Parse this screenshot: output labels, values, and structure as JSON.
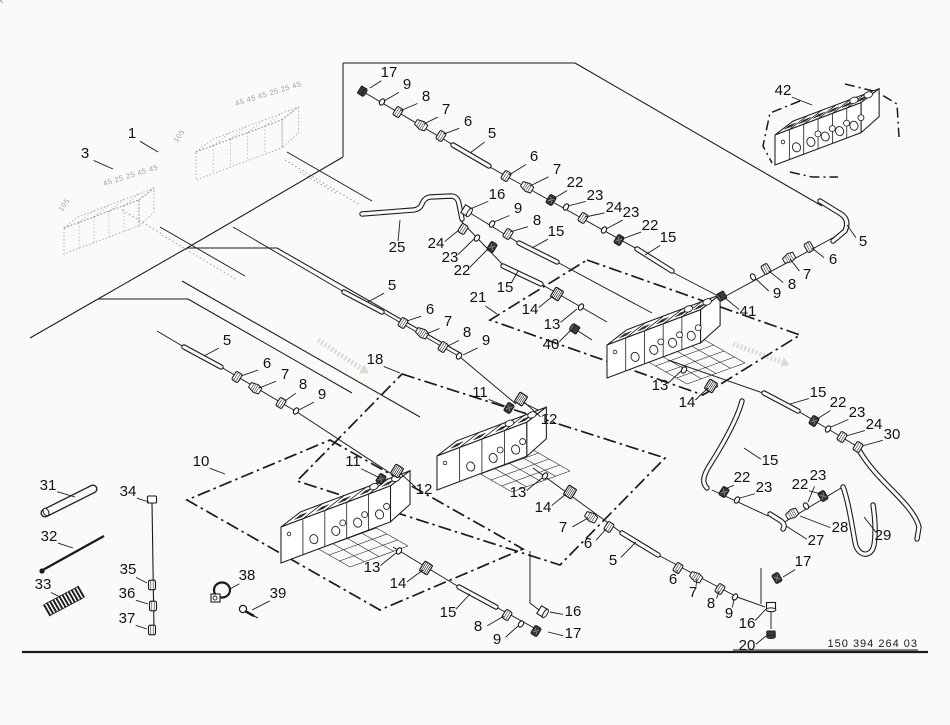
{
  "canvas": {
    "w": 950,
    "h": 725,
    "bg": "#fafaf8",
    "ink": "#1b1b1b"
  },
  "part_number": {
    "text": "150 394 264 03"
  },
  "border": {
    "x1": 22,
    "y1": 652,
    "x2": 928,
    "y2": 652
  },
  "pn_underline": {
    "x1": 733,
    "y1": 650,
    "x2": 918,
    "y2": 650
  },
  "frame_lines": [
    [
      343,
      63,
      343,
      157
    ],
    [
      343,
      63,
      575,
      63
    ],
    [
      575,
      63,
      822,
      206
    ],
    [
      343,
      157,
      187,
      248
    ],
    [
      187,
      248,
      277,
      248
    ],
    [
      277,
      248,
      462,
      354
    ],
    [
      187,
      248,
      98,
      299
    ],
    [
      98,
      299,
      188,
      299
    ],
    [
      188,
      299,
      352,
      393
    ],
    [
      182,
      281,
      420,
      417
    ],
    [
      98,
      299,
      30,
      338
    ]
  ],
  "areas": [
    {
      "pts": [
        [
          330,
          440
        ],
        [
          523,
          549
        ],
        [
          380,
          610
        ],
        [
          187,
          500
        ]
      ]
    },
    {
      "pts": [
        [
          402,
          374
        ],
        [
          665,
          458
        ],
        [
          560,
          565
        ],
        [
          297,
          481
        ]
      ]
    },
    {
      "pts": [
        [
          587,
          260
        ],
        [
          800,
          335
        ],
        [
          703,
          395
        ],
        [
          490,
          320
        ]
      ]
    }
  ],
  "brackets": [
    [
      [
        800,
        101
      ],
      [
        770,
        113
      ],
      [
        763,
        146
      ],
      [
        772,
        163
      ]
    ],
    [
      [
        845,
        84
      ],
      [
        877,
        92
      ],
      [
        897,
        104
      ],
      [
        899,
        137
      ]
    ],
    [
      [
        790,
        172
      ],
      [
        812,
        177
      ],
      [
        838,
        177
      ]
    ]
  ],
  "end_brackets": [
    [
      [
        530,
        551
      ],
      [
        530,
        603
      ],
      [
        539,
        610
      ]
    ],
    [
      [
        761,
        568
      ],
      [
        761,
        604
      ]
    ],
    [
      [
        771,
        612
      ],
      [
        771,
        629
      ]
    ]
  ],
  "hose_lines": [
    [
      362,
      91,
      455,
      146
    ],
    [
      488,
      166,
      637,
      249
    ],
    [
      672,
      272,
      722,
      298
    ],
    [
      470,
      213,
      519,
      243
    ],
    [
      557,
      262,
      652,
      313
    ],
    [
      460,
      220,
      505,
      267
    ],
    [
      541,
      284,
      607,
      322
    ],
    [
      578,
      331,
      592,
      340
    ],
    [
      233,
      227,
      344,
      292
    ],
    [
      382,
      312,
      460,
      357
    ],
    [
      460,
      357,
      516,
      404
    ],
    [
      522,
      402,
      548,
      415
    ],
    [
      157,
      331,
      184,
      347
    ],
    [
      221,
      367,
      297,
      412
    ],
    [
      297,
      412,
      390,
      473
    ],
    [
      393,
      547,
      459,
      587
    ],
    [
      496,
      607,
      538,
      630
    ],
    [
      533,
      468,
      622,
      533
    ],
    [
      658,
      555,
      737,
      597
    ],
    [
      737,
      597,
      765,
      607
    ],
    [
      840,
      234,
      700,
      310
    ],
    [
      668,
      360,
      763,
      393
    ],
    [
      798,
      411,
      858,
      447
    ],
    [
      712,
      490,
      768,
      516
    ],
    [
      783,
      523,
      841,
      488
    ],
    [
      287,
      152,
      372,
      201
    ],
    [
      160,
      227,
      245,
      276
    ]
  ],
  "pipes": [
    {
      "d": "M453,145 L489,166"
    },
    {
      "d": "M637,249 L672,271"
    },
    {
      "d": "M519,243 L557,262"
    },
    {
      "d": "M503,266 L541,284"
    },
    {
      "d": "M344,292 L382,312"
    },
    {
      "d": "M184,347 L221,367"
    },
    {
      "d": "M459,587 L496,607"
    },
    {
      "d": "M622,533 L658,555"
    },
    {
      "d": "M764,393 L798,411"
    },
    {
      "d": "M362,214 L414,210 Q420,209 422,204 Q424,198 430,197 L452,196 Q458,197 459,204 L462,219"
    },
    {
      "d": "M820,201 L841,214 Q850,220 845,231 L833,241"
    },
    {
      "d": "M843,487 C848,500 851,520 855,542 C857,556 871,559 874,545 C876,533 875,517 873,505"
    },
    {
      "d": "M858,448 C864,460 875,473 890,488 C905,503 916,515 919,527 L917,539"
    },
    {
      "d": "M742,401 C737,420 722,446 708,468 C703,477 702,483 707,488"
    },
    {
      "d": "M770,514 L781,521 Q786,525 783,529"
    }
  ],
  "fittings": [
    [
      "cap",
      362,
      91,
      32,
      1
    ],
    [
      "washer",
      382,
      102,
      32,
      0
    ],
    [
      "nut",
      398,
      112,
      32,
      0
    ],
    [
      "cone",
      421,
      125,
      32,
      0
    ],
    [
      "nut",
      441,
      136,
      32,
      0
    ],
    [
      "nut",
      506,
      176,
      32,
      0
    ],
    [
      "cone",
      527,
      187,
      32,
      0
    ],
    [
      "nutD",
      551,
      200,
      32,
      1
    ],
    [
      "washer",
      566,
      207,
      32,
      0
    ],
    [
      "nut",
      583,
      218,
      32,
      0
    ],
    [
      "washer",
      604,
      230,
      32,
      0
    ],
    [
      "nutD",
      619,
      240,
      32,
      1
    ],
    [
      "flange",
      467,
      211,
      32,
      0
    ],
    [
      "washer",
      492,
      224,
      32,
      0
    ],
    [
      "nut",
      508,
      234,
      32,
      0
    ],
    [
      "nut",
      463,
      229,
      32,
      0
    ],
    [
      "washer",
      477,
      238,
      32,
      0
    ],
    [
      "nutD",
      492,
      247,
      32,
      1
    ],
    [
      "hex",
      557,
      294,
      32,
      0
    ],
    [
      "washer",
      581,
      307,
      32,
      0
    ],
    [
      "plug",
      575,
      329,
      32,
      1
    ],
    [
      "nut",
      403,
      323,
      32,
      0
    ],
    [
      "cone",
      422,
      333,
      32,
      0
    ],
    [
      "nut",
      443,
      347,
      32,
      0
    ],
    [
      "washer",
      459,
      356,
      32,
      0
    ],
    [
      "nutD",
      509,
      408,
      32,
      1
    ],
    [
      "hex",
      521,
      399,
      32,
      0
    ],
    [
      "nut",
      237,
      377,
      32,
      0
    ],
    [
      "cone",
      255,
      388,
      32,
      0
    ],
    [
      "nut",
      281,
      403,
      32,
      0
    ],
    [
      "washer",
      296,
      411,
      32,
      0
    ],
    [
      "nutD",
      381,
      479,
      32,
      1
    ],
    [
      "hex",
      397,
      471,
      32,
      0
    ],
    [
      "washer",
      399,
      551,
      32,
      0
    ],
    [
      "hex",
      426,
      568,
      32,
      0
    ],
    [
      "nut",
      507,
      615,
      32,
      0
    ],
    [
      "washer",
      521,
      624,
      32,
      0
    ],
    [
      "flange",
      543,
      612,
      32,
      0
    ],
    [
      "nutD",
      536,
      631,
      32,
      1
    ],
    [
      "washer",
      545,
      476,
      32,
      0
    ],
    [
      "hex",
      570,
      492,
      32,
      0
    ],
    [
      "cone",
      591,
      517,
      32,
      0
    ],
    [
      "nut",
      609,
      527,
      32,
      0
    ],
    [
      "nut",
      678,
      568,
      32,
      0
    ],
    [
      "cone",
      696,
      577,
      32,
      0
    ],
    [
      "nut",
      720,
      589,
      32,
      0
    ],
    [
      "washer",
      735,
      597,
      32,
      0
    ],
    [
      "nutD",
      777,
      578,
      -30,
      1
    ],
    [
      "flange",
      771,
      607,
      90,
      0
    ],
    [
      "cap",
      771,
      634,
      90,
      1
    ],
    [
      "nut",
      809,
      247,
      -30,
      0
    ],
    [
      "cone",
      789,
      258,
      -30,
      0
    ],
    [
      "nut",
      766,
      269,
      -30,
      0
    ],
    [
      "washer",
      753,
      277,
      -30,
      0
    ],
    [
      "plug",
      722,
      296,
      -30,
      1
    ],
    [
      "washer",
      684,
      370,
      32,
      0
    ],
    [
      "hex",
      711,
      386,
      32,
      0
    ],
    [
      "nutD",
      814,
      421,
      32,
      1
    ],
    [
      "washer",
      828,
      429,
      32,
      0
    ],
    [
      "nut",
      842,
      437,
      32,
      0
    ],
    [
      "nut",
      858,
      447,
      32,
      0
    ],
    [
      "nutD",
      724,
      492,
      32,
      1
    ],
    [
      "washer",
      737,
      500,
      32,
      0
    ],
    [
      "cone",
      792,
      514,
      -30,
      0
    ],
    [
      "washer",
      806,
      506,
      -30,
      0
    ],
    [
      "nutD",
      823,
      496,
      -30,
      1
    ],
    [
      "nut",
      152,
      585,
      0,
      0
    ],
    [
      "nut",
      153,
      606,
      0,
      0
    ],
    [
      "nut",
      152,
      630,
      0,
      0
    ]
  ],
  "blocks": [
    {
      "x": 281,
      "y": 527,
      "len": 117,
      "h": 36,
      "dep": 26,
      "n": 5
    },
    {
      "x": 437,
      "y": 456,
      "len": 96,
      "h": 34,
      "dep": 26,
      "n": 4
    },
    {
      "x": 607,
      "y": 345,
      "len": 100,
      "h": 33,
      "dep": 26,
      "n": 5
    },
    {
      "x": 775,
      "y": 135,
      "len": 92,
      "h": 30,
      "dep": 24,
      "n": 6
    }
  ],
  "ghost_blocks": [
    {
      "x": 196,
      "y": 152,
      "len": 92,
      "h": 28,
      "dep": 22,
      "n": 5
    },
    {
      "x": 64,
      "y": 228,
      "len": 80,
      "h": 26,
      "dep": 20,
      "n": 5
    }
  ],
  "ghost_texts": [
    [
      "45 45 45 25 25 45",
      236,
      106,
      -17
    ],
    [
      "105",
      177,
      143,
      -55
    ],
    [
      "45 25 25 45 45",
      104,
      186,
      -17
    ],
    [
      "105",
      62,
      212,
      -55
    ]
  ],
  "ghost_lines": [
    [
      285,
      160,
      360,
      205
    ],
    [
      162,
      235,
      237,
      280
    ],
    [
      300,
      172,
      337,
      194
    ],
    [
      122,
      210,
      162,
      234
    ]
  ],
  "ghost_arrows": [
    [
      318,
      340,
      362,
      369
    ],
    [
      733,
      344,
      782,
      362
    ]
  ],
  "lattices": [
    {
      "x": 308,
      "y": 543
    },
    {
      "x": 470,
      "y": 468
    },
    {
      "x": 645,
      "y": 360
    }
  ],
  "small_parts": {
    "tube31": {
      "x1": 45,
      "y1": 513,
      "x2": 93,
      "y2": 489
    },
    "rod32": {
      "x1": 41,
      "y1": 571,
      "x2": 104,
      "y2": 536
    },
    "spring33": {
      "x1": 47,
      "y1": 610,
      "x2": 81,
      "y2": 592,
      "coils": 11
    },
    "bolt34": {
      "hx": 152,
      "hy": 501,
      "x2": 154,
      "y2": 631
    },
    "clamp38": {
      "x": 222,
      "y": 592
    },
    "screw39": {
      "x": 246,
      "y": 611
    }
  },
  "callouts": [
    [
      "1",
      132,
      133,
      158,
      152
    ],
    [
      "3",
      85,
      153,
      113,
      169
    ],
    [
      "17",
      389,
      72,
      370,
      88
    ],
    [
      "9",
      407,
      84,
      384,
      101
    ],
    [
      "8",
      426,
      96,
      400,
      111
    ],
    [
      "7",
      446,
      109,
      424,
      124
    ],
    [
      "6",
      468,
      121,
      444,
      134
    ],
    [
      "5",
      492,
      133,
      470,
      153
    ],
    [
      "6",
      534,
      156,
      509,
      175
    ],
    [
      "7",
      557,
      169,
      530,
      186
    ],
    [
      "22",
      575,
      182,
      553,
      199
    ],
    [
      "23",
      595,
      195,
      568,
      206
    ],
    [
      "24",
      614,
      207,
      585,
      217
    ],
    [
      "23",
      631,
      212,
      606,
      229
    ],
    [
      "22",
      650,
      225,
      622,
      239
    ],
    [
      "15",
      668,
      237,
      645,
      255
    ],
    [
      "16",
      497,
      194,
      470,
      209
    ],
    [
      "9",
      518,
      208,
      494,
      222
    ],
    [
      "8",
      537,
      220,
      510,
      232
    ],
    [
      "15",
      556,
      231,
      532,
      248
    ],
    [
      "25",
      397,
      247,
      400,
      220
    ],
    [
      "24",
      436,
      243,
      459,
      230
    ],
    [
      "23",
      450,
      257,
      474,
      239
    ],
    [
      "22",
      462,
      270,
      489,
      248
    ],
    [
      "15",
      505,
      287,
      518,
      271
    ],
    [
      "21",
      478,
      297,
      497,
      314
    ],
    [
      "14",
      530,
      309,
      553,
      296
    ],
    [
      "13",
      552,
      324,
      577,
      309
    ],
    [
      "40",
      551,
      344,
      571,
      330
    ],
    [
      "5",
      392,
      285,
      368,
      302
    ],
    [
      "6",
      430,
      309,
      407,
      321
    ],
    [
      "7",
      448,
      321,
      426,
      334
    ],
    [
      "8",
      467,
      332,
      448,
      346
    ],
    [
      "9",
      486,
      340,
      463,
      355
    ],
    [
      "18",
      375,
      359,
      400,
      373
    ],
    [
      "5",
      227,
      340,
      204,
      356
    ],
    [
      "6",
      267,
      363,
      241,
      376
    ],
    [
      "7",
      285,
      374,
      259,
      388
    ],
    [
      "8",
      303,
      384,
      285,
      401
    ],
    [
      "9",
      322,
      394,
      299,
      410
    ],
    [
      "10",
      201,
      461,
      225,
      474
    ],
    [
      "11",
      353,
      461,
      378,
      477
    ],
    [
      "12",
      424,
      489,
      401,
      474
    ],
    [
      "13",
      372,
      567,
      396,
      553
    ],
    [
      "14",
      398,
      583,
      423,
      570
    ],
    [
      "15",
      448,
      612,
      470,
      594
    ],
    [
      "8",
      478,
      626,
      504,
      616
    ],
    [
      "9",
      497,
      639,
      518,
      626
    ],
    [
      "16",
      573,
      611,
      550,
      612
    ],
    [
      "17",
      573,
      633,
      548,
      632
    ],
    [
      "11",
      480,
      392,
      505,
      406
    ],
    [
      "12",
      549,
      419,
      524,
      402
    ],
    [
      "13",
      518,
      492,
      542,
      478
    ],
    [
      "14",
      543,
      507,
      566,
      494
    ],
    [
      "7",
      563,
      527,
      588,
      518
    ],
    [
      "6",
      588,
      543,
      606,
      529
    ],
    [
      "5",
      613,
      560,
      636,
      542
    ],
    [
      "6",
      673,
      579,
      677,
      570
    ],
    [
      "7",
      693,
      592,
      697,
      579
    ],
    [
      "8",
      711,
      603,
      719,
      591
    ],
    [
      "9",
      729,
      613,
      734,
      599
    ],
    [
      "17",
      803,
      561,
      783,
      577
    ],
    [
      "16",
      747,
      623,
      766,
      609
    ],
    [
      "20",
      747,
      645,
      766,
      636
    ],
    [
      "42",
      783,
      90,
      812,
      105
    ],
    [
      "5",
      863,
      241,
      847,
      225
    ],
    [
      "6",
      833,
      259,
      812,
      248
    ],
    [
      "7",
      807,
      274,
      790,
      259
    ],
    [
      "8",
      792,
      284,
      769,
      271
    ],
    [
      "9",
      777,
      293,
      756,
      279
    ],
    [
      "41",
      748,
      311,
      725,
      298
    ],
    [
      "13",
      660,
      385,
      681,
      371
    ],
    [
      "14",
      687,
      402,
      708,
      388
    ],
    [
      "15",
      818,
      392,
      790,
      404
    ],
    [
      "22",
      838,
      402,
      817,
      419
    ],
    [
      "23",
      857,
      412,
      831,
      427
    ],
    [
      "24",
      874,
      424,
      846,
      436
    ],
    [
      "30",
      892,
      434,
      862,
      446
    ],
    [
      "15",
      770,
      460,
      744,
      448
    ],
    [
      "22",
      742,
      477,
      725,
      489
    ],
    [
      "23",
      764,
      487,
      740,
      498
    ],
    [
      "22",
      800,
      484,
      821,
      494
    ],
    [
      "23",
      818,
      475,
      808,
      502
    ],
    [
      "28",
      840,
      527,
      800,
      516
    ],
    [
      "27",
      816,
      540,
      786,
      526
    ],
    [
      "29",
      883,
      535,
      864,
      517
    ],
    [
      "31",
      48,
      485,
      75,
      497
    ],
    [
      "32",
      49,
      536,
      73,
      548
    ],
    [
      "33",
      43,
      584,
      60,
      597
    ],
    [
      "34",
      128,
      491,
      149,
      502
    ],
    [
      "35",
      128,
      569,
      147,
      583
    ],
    [
      "36",
      127,
      593,
      148,
      604
    ],
    [
      "37",
      127,
      618,
      147,
      629
    ],
    [
      "38",
      247,
      575,
      230,
      589
    ],
    [
      "39",
      278,
      593,
      252,
      610
    ]
  ]
}
